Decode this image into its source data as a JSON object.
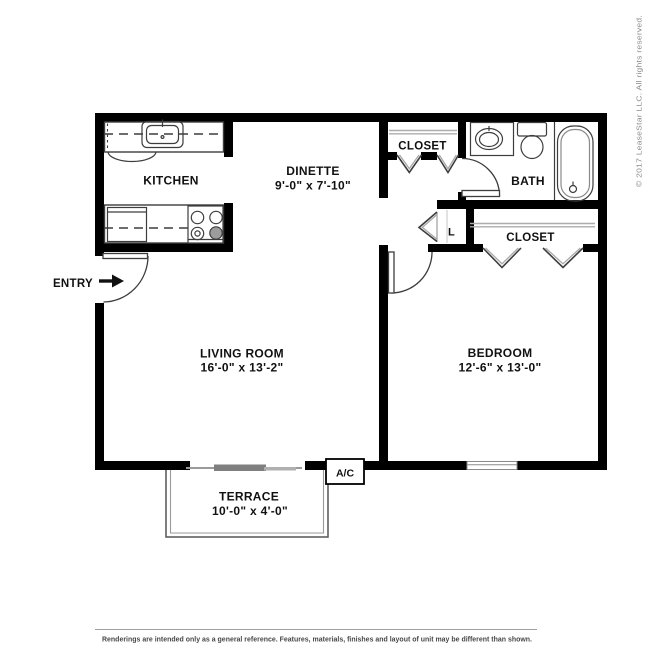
{
  "rooms": {
    "kitchen": {
      "label": "KITCHEN"
    },
    "dinette": {
      "label": "DINETTE",
      "dimensions": "9'-0\" x 7'-10\""
    },
    "living_room": {
      "label": "LIVING ROOM",
      "dimensions": "16'-0\" x 13'-2\""
    },
    "bedroom": {
      "label": "BEDROOM",
      "dimensions": "12'-6\" x 13'-0\""
    },
    "bath": {
      "label": "BATH"
    },
    "terrace": {
      "label": "TERRACE",
      "dimensions": "10'-0\" x 4'-0\""
    },
    "hall_closet": {
      "label": "CLOSET"
    },
    "bedroom_closet": {
      "label": "CLOSET"
    },
    "linen_closet": {
      "label": "L"
    },
    "entry": {
      "label": "ENTRY"
    },
    "ac_unit": {
      "label": "A/C"
    }
  },
  "title_block": {
    "copyright": "© 2017 LeaseStar LLC. All rights reserved.",
    "disclaimer": "Renderings are intended only as a general reference. Features, materials, finishes and layout of unit may be different than shown."
  },
  "colors": {
    "wall": "#000000",
    "label_text": "#111111",
    "fixture_line": "#3d3d3d",
    "gray_light": "#9a9a9a",
    "slider_gray": "#7f7f7f",
    "copyright_text": "#8a8a8a",
    "disclaimer_text": "#474747"
  }
}
